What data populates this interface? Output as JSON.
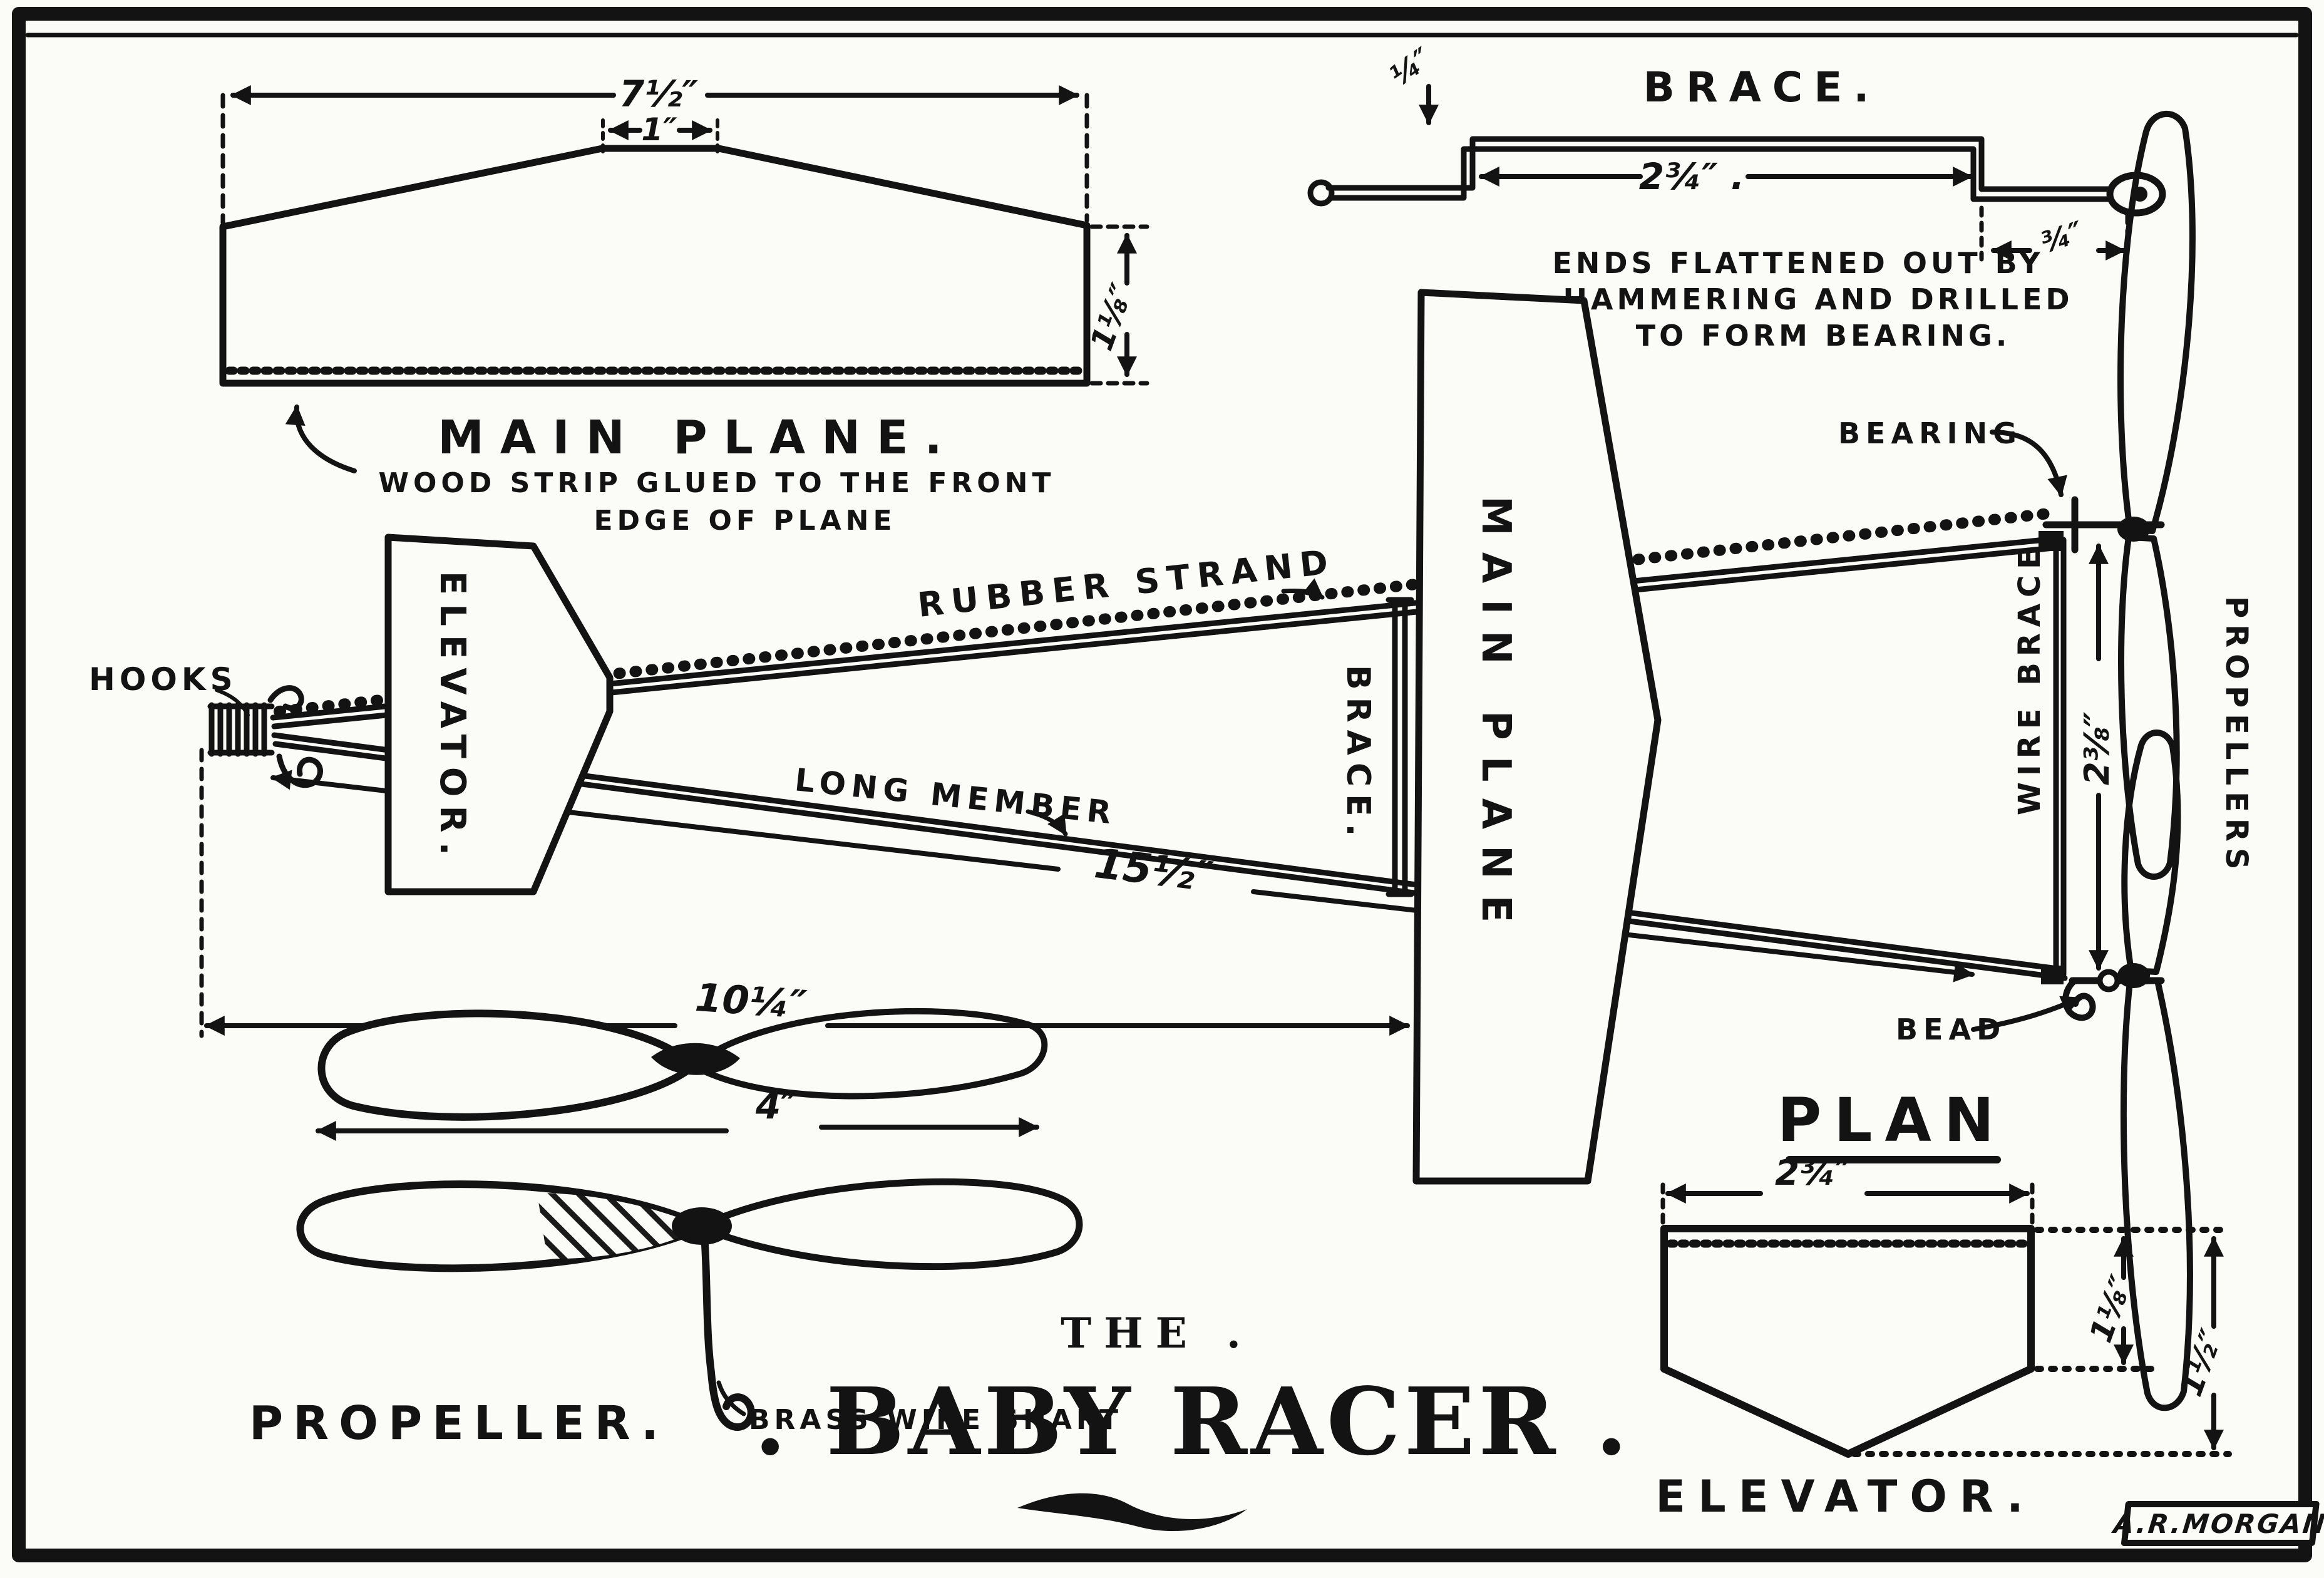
{
  "colors": {
    "ink": "#131313",
    "paper": "#fbfbf8"
  },
  "title": {
    "pre": "THE .",
    "main": ". BABY RACER ."
  },
  "signature": "A.R.MORGAN",
  "main_plane_detail": {
    "caption": "MAIN PLANE.",
    "note1": "WOOD STRIP GLUED TO THE FRONT",
    "note2": "EDGE OF PLANE",
    "dim_span": "7½″",
    "dim_center": "1″",
    "dim_chord": "1⅛″"
  },
  "brace_detail": {
    "caption": "BRACE.",
    "dim_wire": "¼″",
    "dim_span": "2¾″ .",
    "dim_end": "¾″",
    "note1": "ENDS FLATTENED OUT BY",
    "note2": "HAMMERING AND DRILLED",
    "note3": "TO FORM BEARING."
  },
  "plan": {
    "caption": "PLAN",
    "hooks": "HOOKS",
    "elevator": "ELEVATOR.",
    "rubber_strand": "RUBBER STRAND",
    "long_member": "LONG MEMBER",
    "brace": "BRACE.",
    "main_plane": "MAIN PLANE",
    "wire_brace": "WIRE BRACE",
    "bearing": "BEARING",
    "bead": "BEAD",
    "propellers": "PROPELLERS",
    "dim_overall": "15½″",
    "dim_body": "10¼″",
    "dim_prop_gap": "2⅜″"
  },
  "propeller_detail": {
    "caption": "PROPELLER.",
    "dim_diameter": "4″",
    "shaft": "BRASS WIRE SHAFT"
  },
  "elevator_detail": {
    "caption": "ELEVATOR.",
    "dim_width": "2¾″",
    "dim_side": "1⅛″",
    "dim_total": "1½″"
  }
}
